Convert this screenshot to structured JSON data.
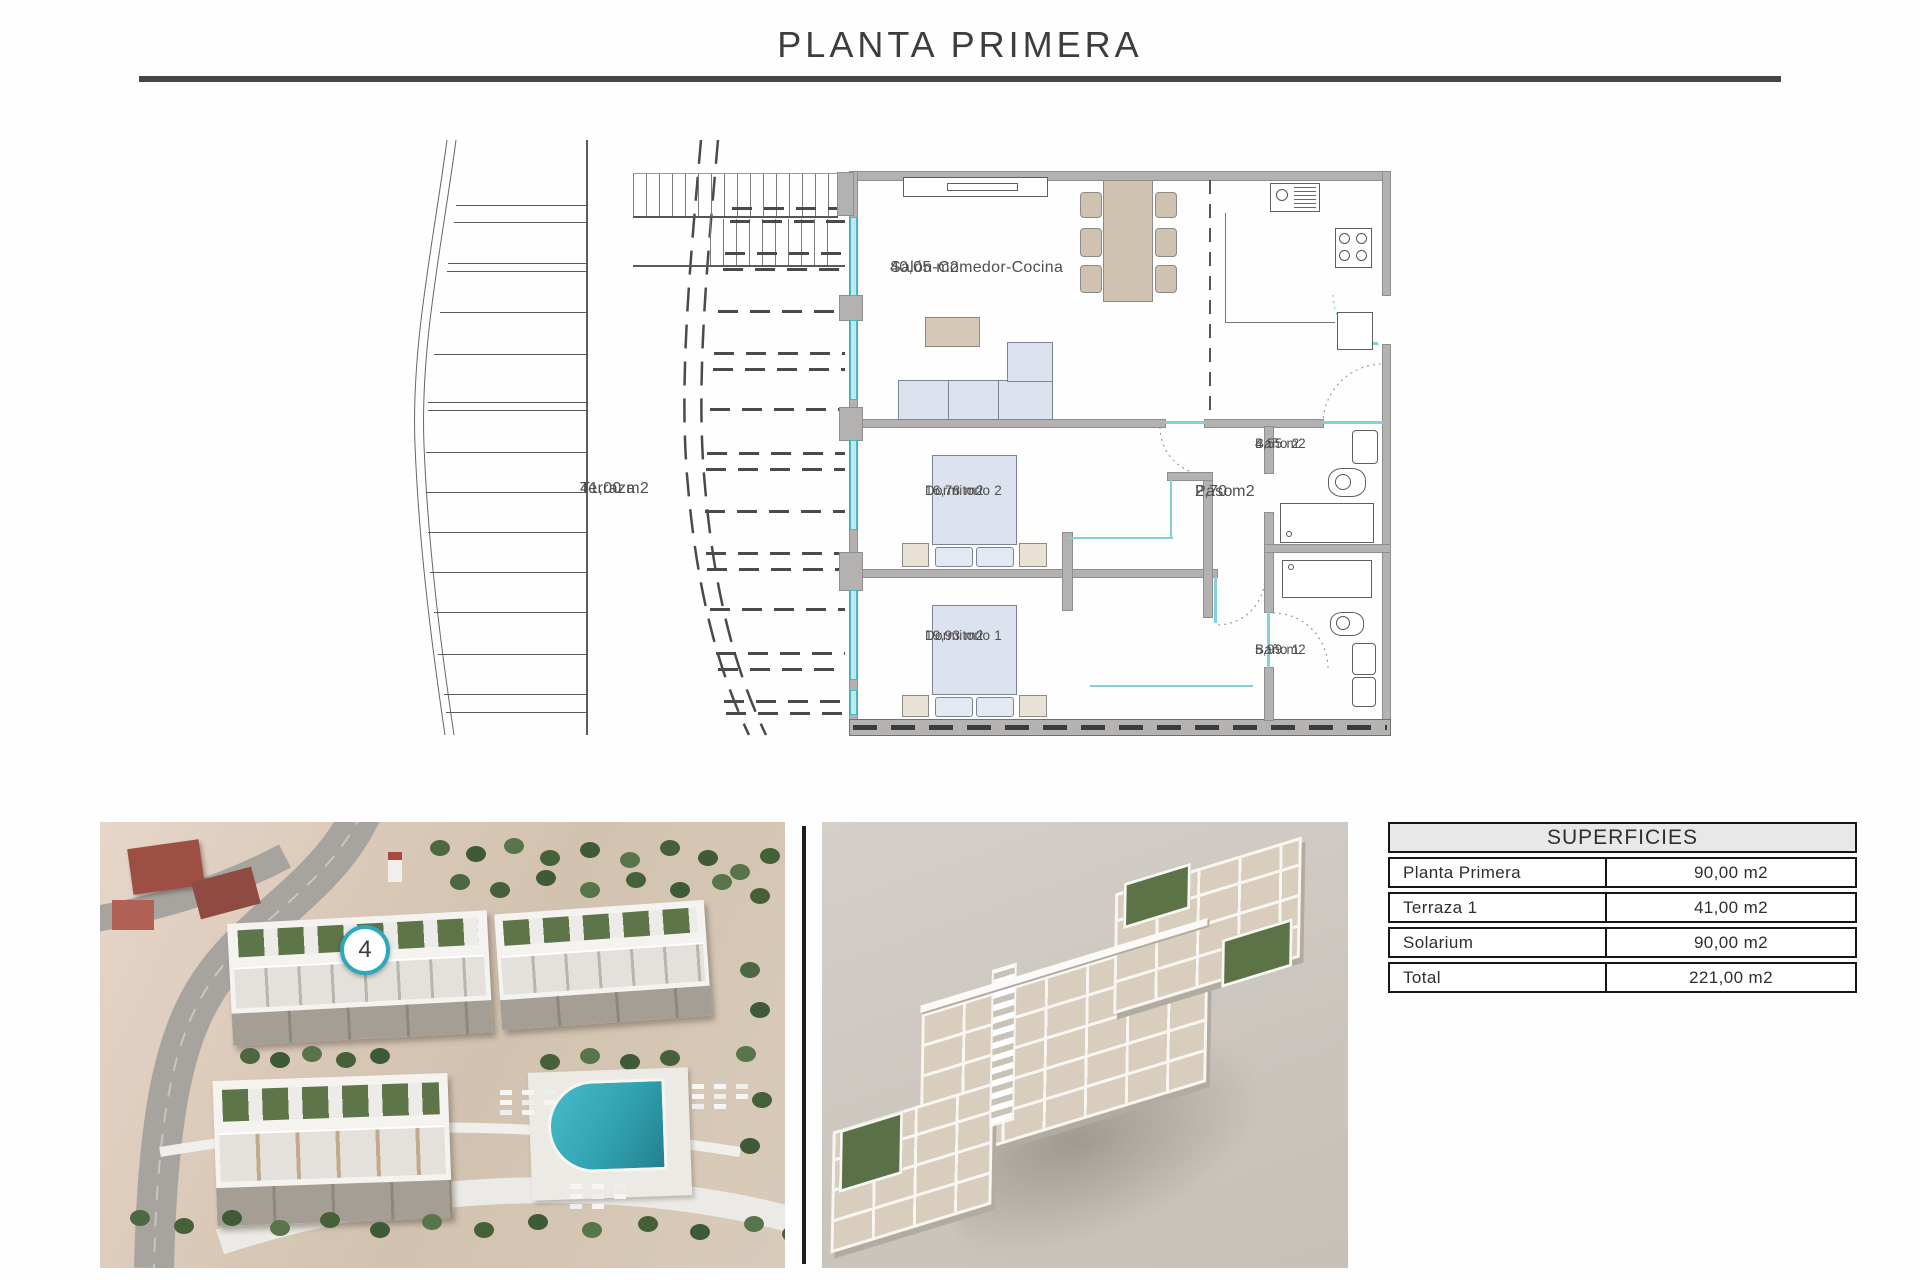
{
  "page": {
    "title": "PLANTA PRIMERA"
  },
  "plan": {
    "rooms": {
      "terraza": {
        "name": "Terraza",
        "area": "41,00 m2"
      },
      "salon": {
        "name": "Salón-Comedor-Cocina",
        "area": "40,05 m2"
      },
      "dormitorio2": {
        "name": "Dormitorio 2",
        "area": "16,78 m2"
      },
      "dormitorio1": {
        "name": "Dormitorio 1",
        "area": "19,93 m2"
      },
      "paso": {
        "name": "Paso",
        "area": "2,70 m2"
      },
      "bano2": {
        "name": "Baño 2",
        "area": "4,55 m2"
      },
      "bano1": {
        "name": "Baño 1",
        "area": "5,99 m2"
      }
    }
  },
  "site_photo": {
    "unit_badge": "4"
  },
  "surfaces_table": {
    "title": "SUPERFICIES",
    "rows": [
      {
        "label": "Planta Primera",
        "value": "90,00 m2"
      },
      {
        "label": "Terraza 1",
        "value": "41,00 m2"
      },
      {
        "label": "Solarium",
        "value": "90,00 m2"
      },
      {
        "label": "Total",
        "value": "221,00 m2"
      }
    ]
  },
  "palette": {
    "accent_cyan": "#49b9c7",
    "wall_gray": "#b3b2b0",
    "furniture_beige": "#cfc2b1",
    "furniture_blue": "#dce3ee",
    "pool_teal": "#35a7b5",
    "rule_gray": "#454545"
  }
}
